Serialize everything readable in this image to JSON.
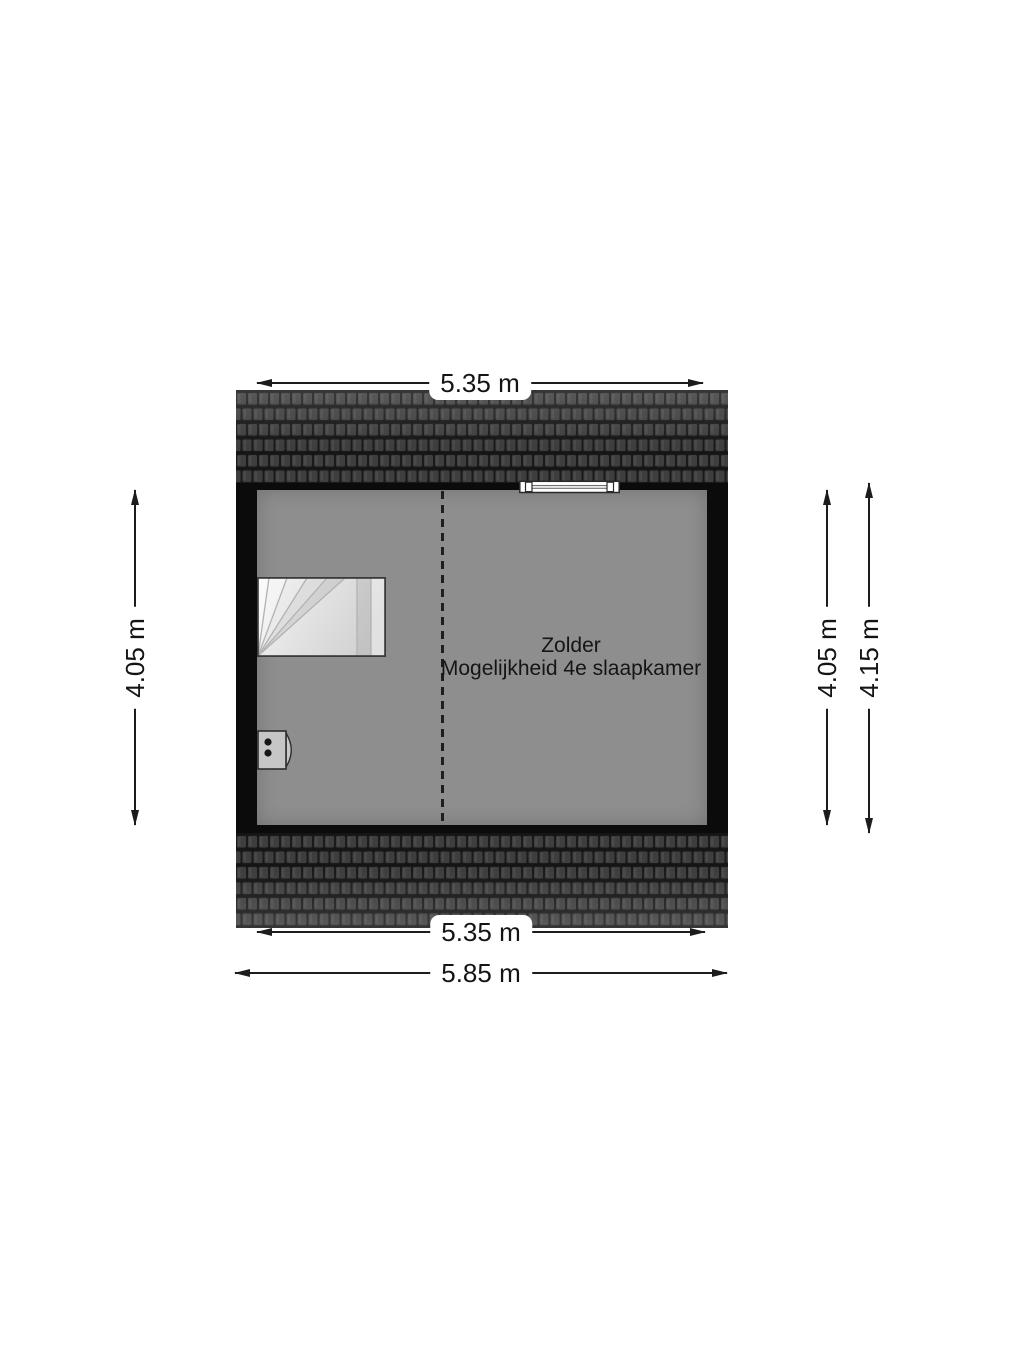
{
  "floorplan": {
    "room": {
      "name": "Zolder",
      "subtitle": "Mogelijkheid 4e slaapkamer"
    },
    "dimensions": {
      "top_width": "5.35 m",
      "left_height": "4.05 m",
      "right_height_inner": "4.05 m",
      "right_height_outer": "4.15 m",
      "bottom_width_inner": "5.35 m",
      "bottom_width_outer": "5.85 m"
    },
    "features": {
      "stairs": "winder-staircase",
      "unit": "heating-unit",
      "window": "roof-window",
      "divider": "dashed-room-divider",
      "roof": "roof-tiles"
    },
    "colors": {
      "background": "#ffffff",
      "floor": "#8f8e8f",
      "wall": "#0b0b0b",
      "roof_tile": "#3e3e3e",
      "roof_gap": "#151515",
      "dimension_line": "#1c1c1c",
      "text": "#151515"
    }
  }
}
